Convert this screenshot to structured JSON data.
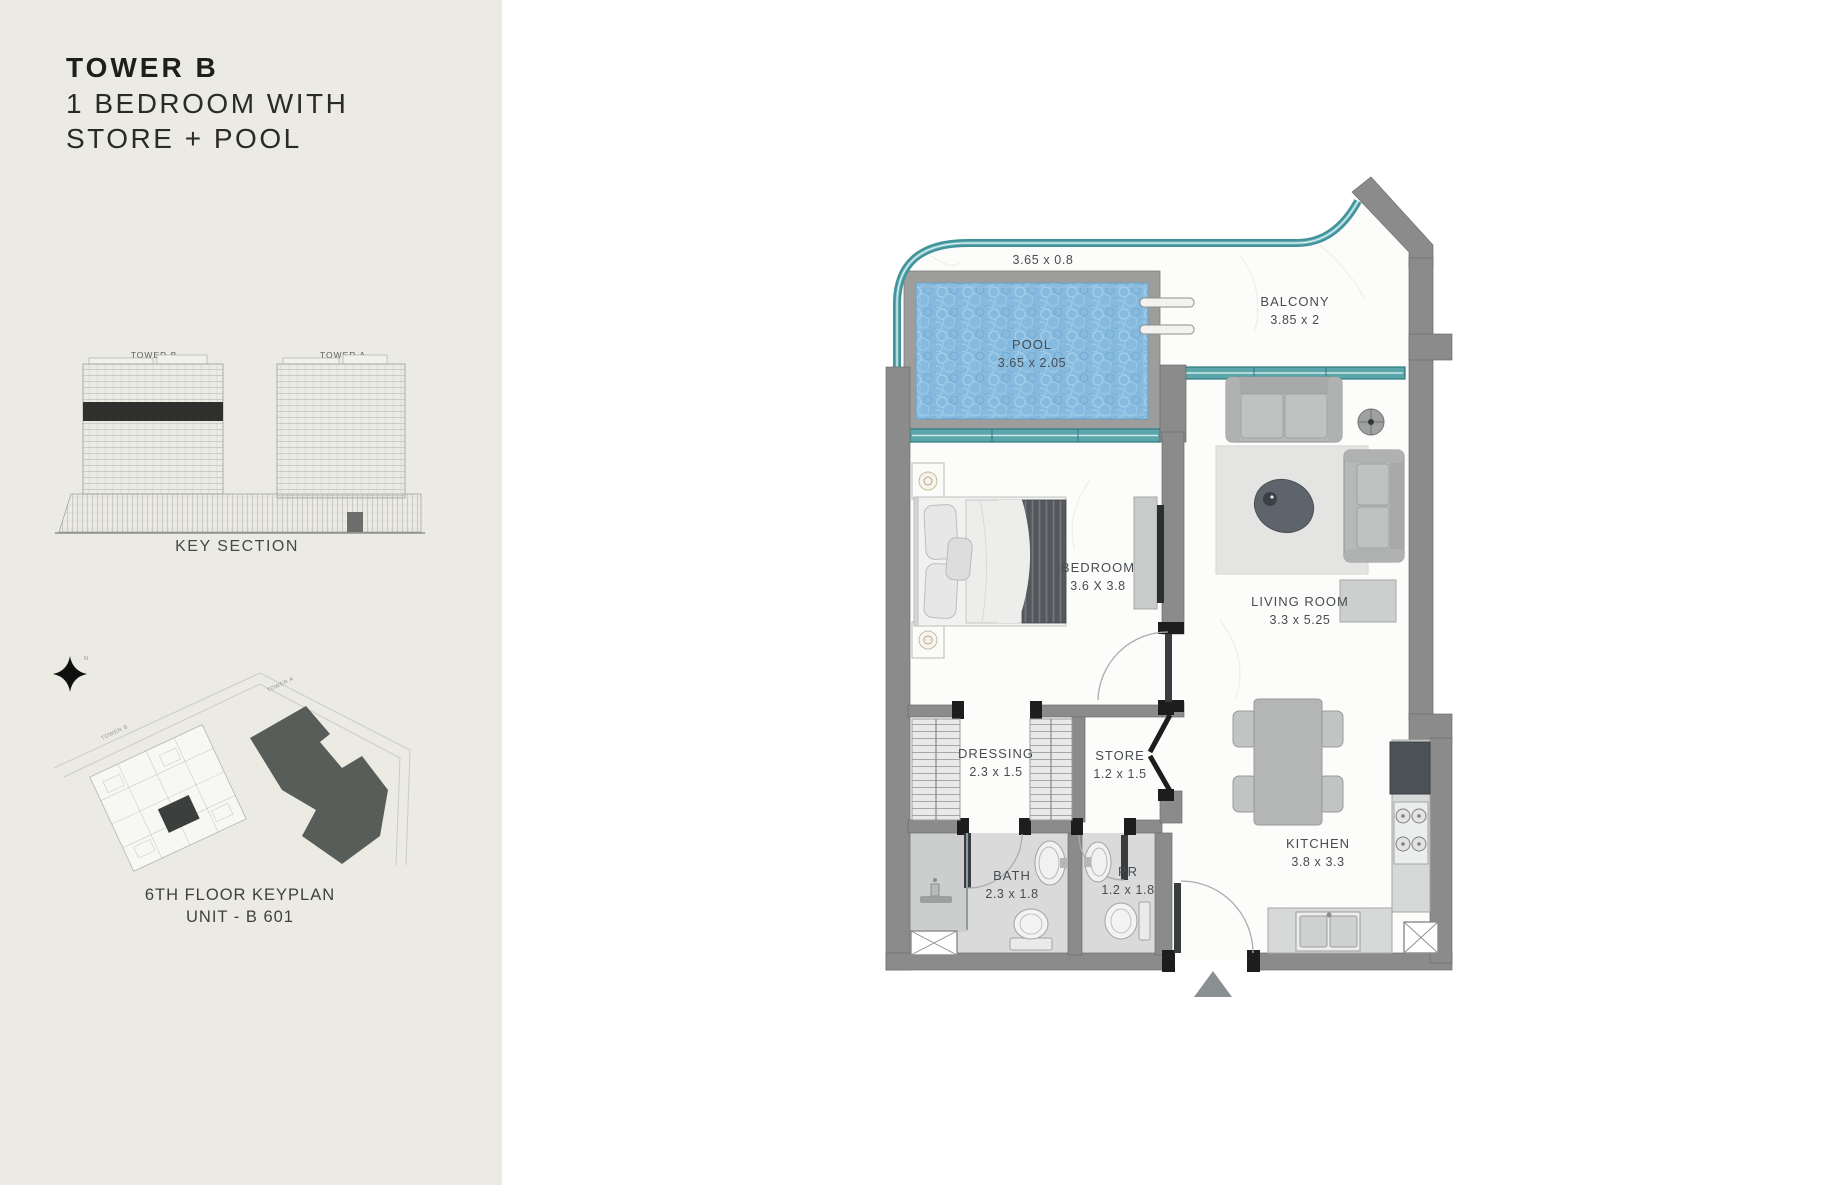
{
  "sidebar": {
    "title": {
      "line1": "TOWER B",
      "line2": "1 BEDROOM WITH",
      "line3": "STORE + POOL"
    },
    "key_section": {
      "tower_b": "TOWER B",
      "tower_a": "TOWER A",
      "caption": "KEY SECTION"
    },
    "keyplan": {
      "tower_b": "TOWER B",
      "tower_a": "TOWER A",
      "north": "N",
      "caption_line1": "6TH FLOOR KEYPLAN",
      "caption_line2": "UNIT - B 601"
    }
  },
  "plan": {
    "deck_dim": "3.65 x 0.8",
    "rooms": {
      "pool": {
        "name": "POOL",
        "dims": "3.65 x 2.05"
      },
      "balcony": {
        "name": "BALCONY",
        "dims": "3.85 x 2"
      },
      "bedroom": {
        "name": "BEDROOM",
        "dims": "3.6 X 3.8"
      },
      "living_room": {
        "name": "LIVING ROOM",
        "dims": "3.3 x  5.25"
      },
      "dressing": {
        "name": "DRESSING",
        "dims": "2.3 x 1.5"
      },
      "store": {
        "name": "STORE",
        "dims": "1.2 x 1.5"
      },
      "bath": {
        "name": "BATH",
        "dims": "2.3 x 1.8"
      },
      "powder_room": {
        "name": "PR",
        "dims": "1.2 x 1.8"
      },
      "kitchen": {
        "name": "KITCHEN",
        "dims": "3.8 x  3.3"
      }
    }
  },
  "colors": {
    "sidebar_bg": "#ecebe3",
    "wall_gray": "#8b8b8b",
    "accent_teal": "#41929a",
    "pool_blue": "#86bade",
    "label_text": "#474d52"
  }
}
